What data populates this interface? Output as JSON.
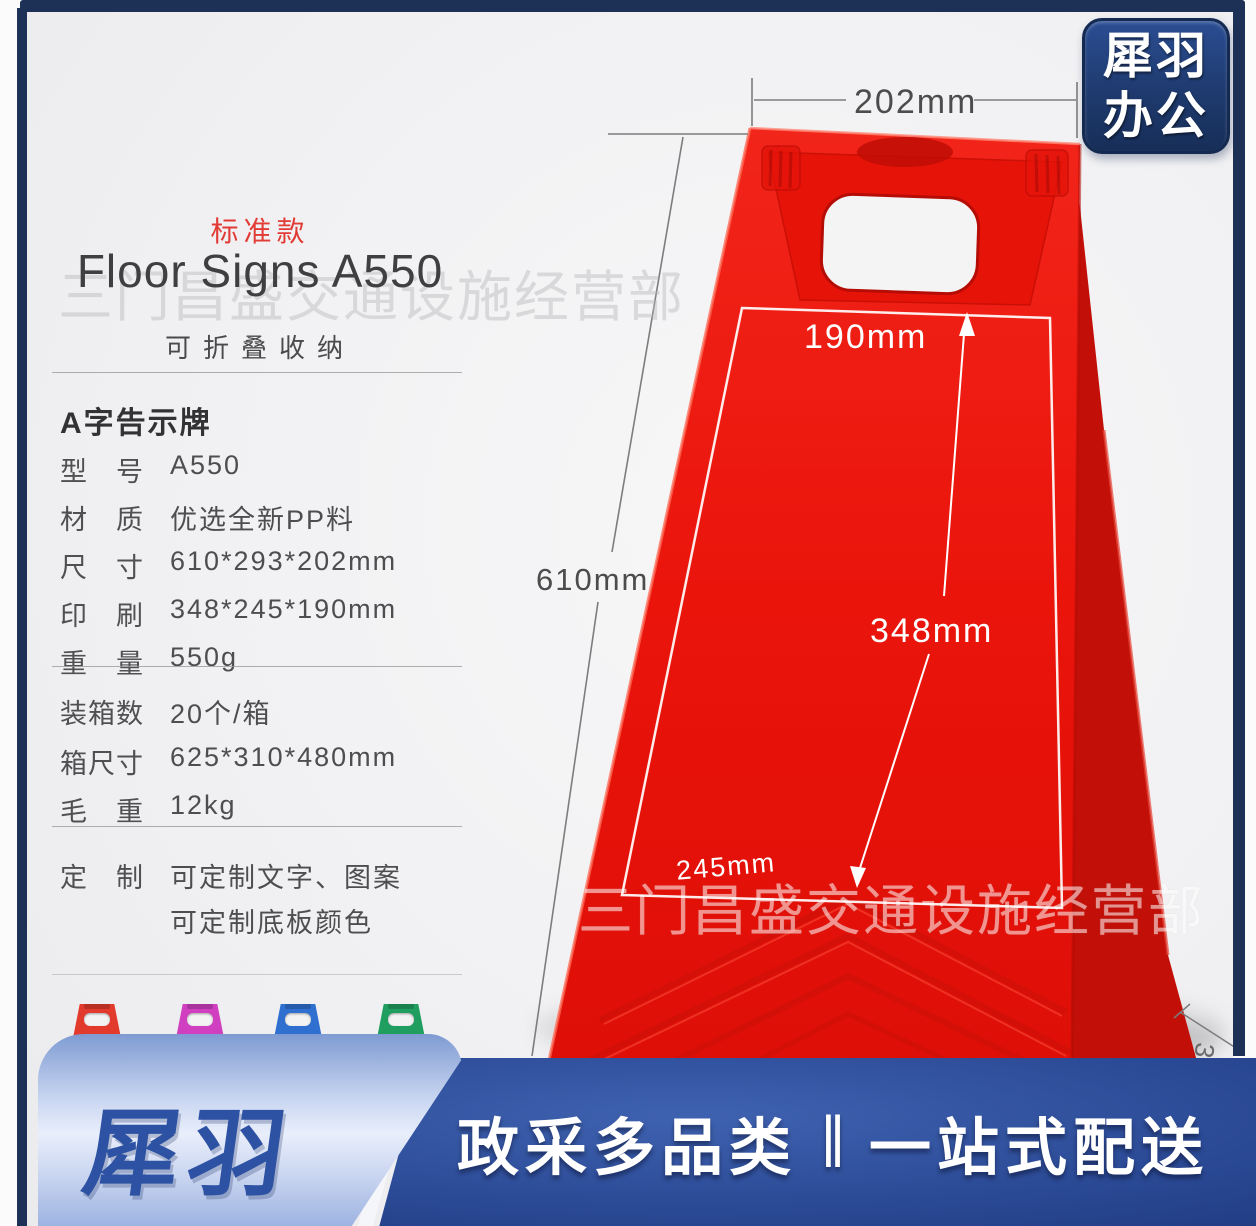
{
  "badge": {
    "line1": "犀羽",
    "line2": "办公"
  },
  "info": {
    "tag": "标准款",
    "title": "Floor Signs A550",
    "subtitle": "可折叠收纳",
    "heading": "A字告示牌",
    "specs": [
      {
        "label": "型　号",
        "value": "A550"
      },
      {
        "label": "材　质",
        "value": "优选全新PP料"
      },
      {
        "label": "尺　寸",
        "value": "610*293*202mm"
      },
      {
        "label": "印　刷",
        "value": "348*245*190mm"
      },
      {
        "label": "重　量",
        "value": "550g"
      }
    ],
    "packing": [
      {
        "label": "装箱数",
        "value": "20个/箱"
      },
      {
        "label": "箱尺寸",
        "value": "625*310*480mm"
      },
      {
        "label": "毛　重",
        "value": "12kg"
      }
    ],
    "custom": {
      "label": "定　制",
      "line1": "可定制文字、图案",
      "line2": "可定制底板颜色"
    }
  },
  "photo": {
    "watermark": "三门昌盛交通设施经营部",
    "dims": {
      "top_width": "202mm",
      "height": "610mm",
      "print_top": "190mm",
      "print_height": "348mm",
      "print_bottom": "245mm",
      "depth_partial": "3"
    }
  },
  "banner": {
    "logo": "犀羽",
    "slogan_left": "政采多品类",
    "separator": "‖",
    "slogan_right": "一站式配送"
  },
  "colors": {
    "frame_navy": "#1d3157",
    "sign_red": "#ea150c",
    "sign_red_dark": "#c21008",
    "banner_dark_blue": "#2b4a96",
    "banner_light_blue": "#cdd9f2",
    "logo_navy": "#1e3a6d",
    "accent_red_text": "#e23b35",
    "mini_variants": [
      "#e23a2c",
      "#cf3fc0",
      "#2e6fd0",
      "#1f9e60"
    ]
  }
}
